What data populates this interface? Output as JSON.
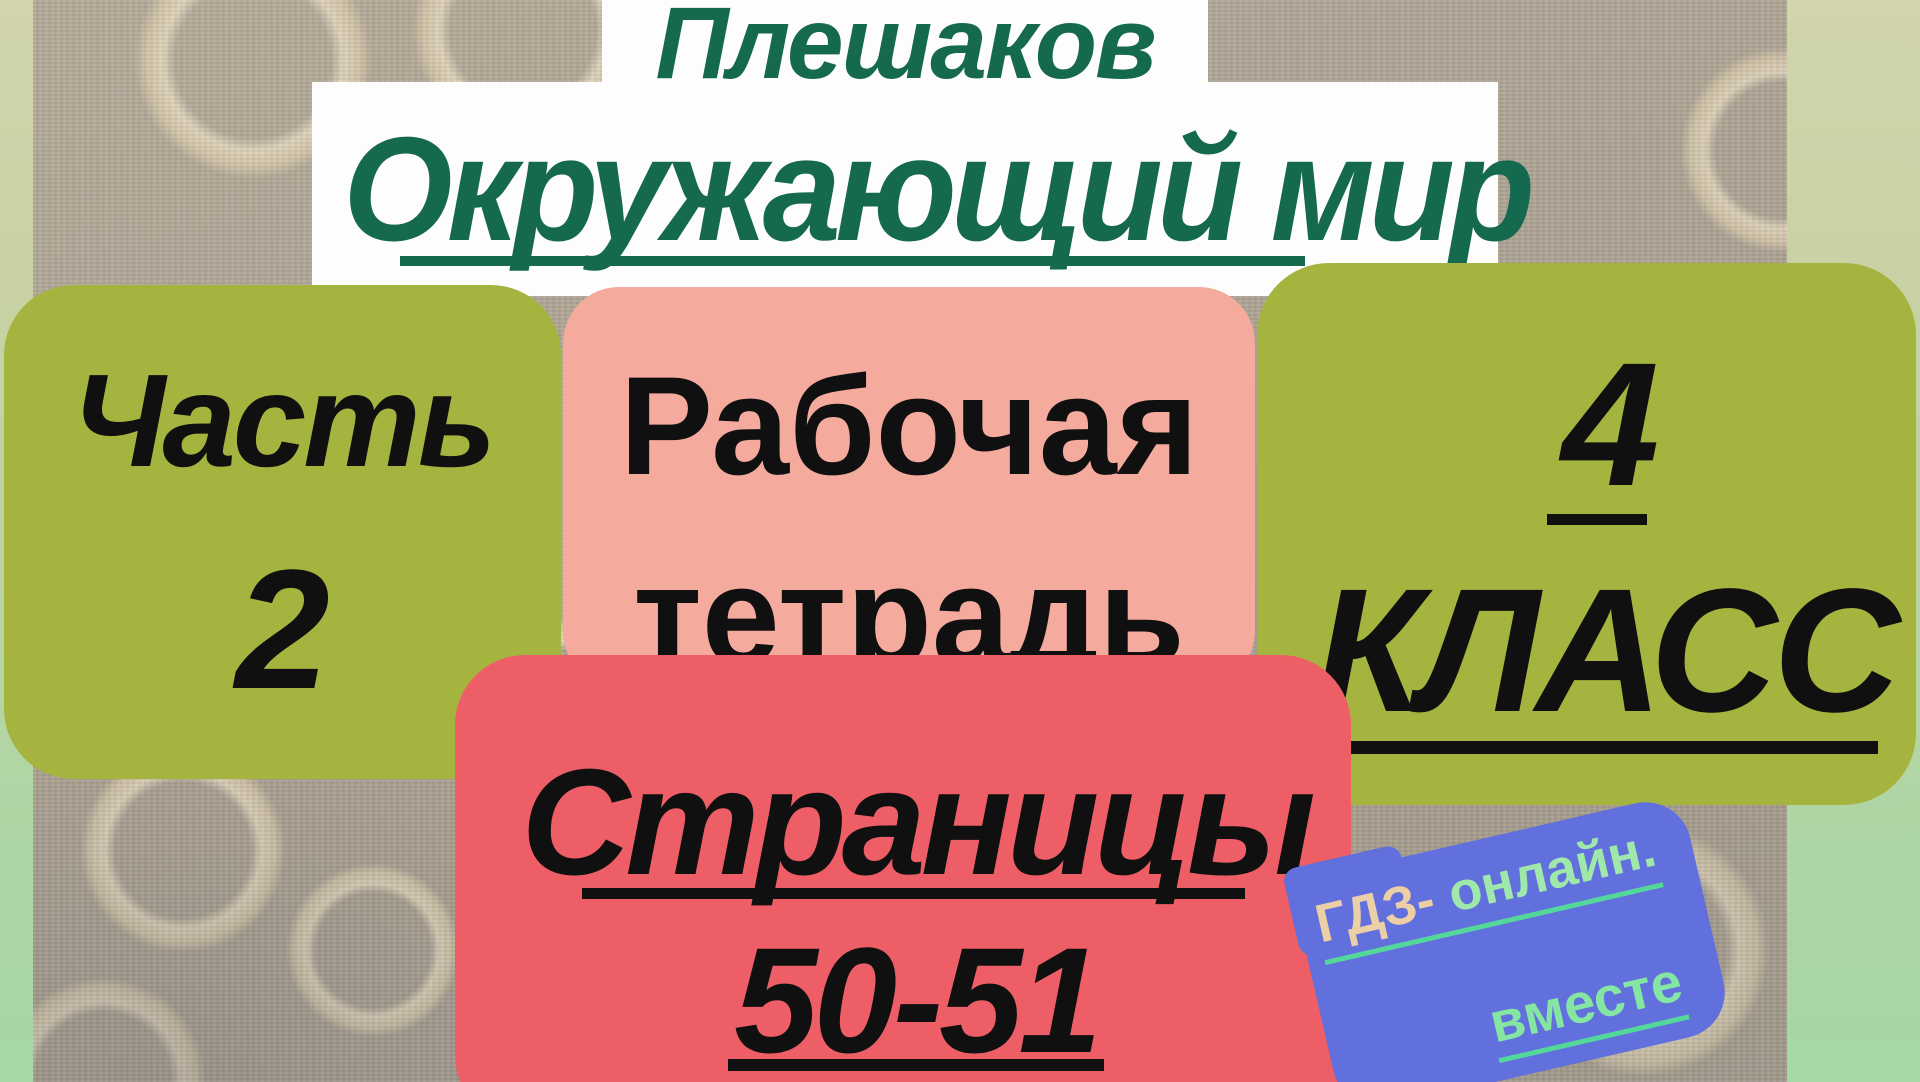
{
  "header": {
    "author": "Плешаков",
    "subject": "Окружающий мир"
  },
  "badges": {
    "part": {
      "word": "Часть",
      "number": "2"
    },
    "workbook": {
      "word1": "Рабочая",
      "word2": "тетрадь"
    },
    "grade": {
      "number": "4",
      "word": "КЛАСС"
    },
    "pages": {
      "word": "Страницы",
      "range": "50-51"
    }
  },
  "watermark": {
    "brand": "ГДЗ-",
    "suffix": "онлайн.",
    "line2": "вместе"
  },
  "colors": {
    "heading_green": "#15694e",
    "badge_olive": "#a5b43e",
    "badge_pink": "#f4aa9c",
    "badge_red": "#ee5e66",
    "badge_blue": "#6170dc",
    "text_black": "#101010",
    "banner_white": "#fdfdfd",
    "watermark_peach": "#eccfa6",
    "watermark_mint": "#9fe7ab",
    "watermark_green": "#85e5a3",
    "underline_teal": "#54d79b",
    "frame_green_top": "#d2d4ac",
    "frame_green_bottom": "#a5d7a7",
    "wallpaper_taupe": "#aaa192"
  }
}
